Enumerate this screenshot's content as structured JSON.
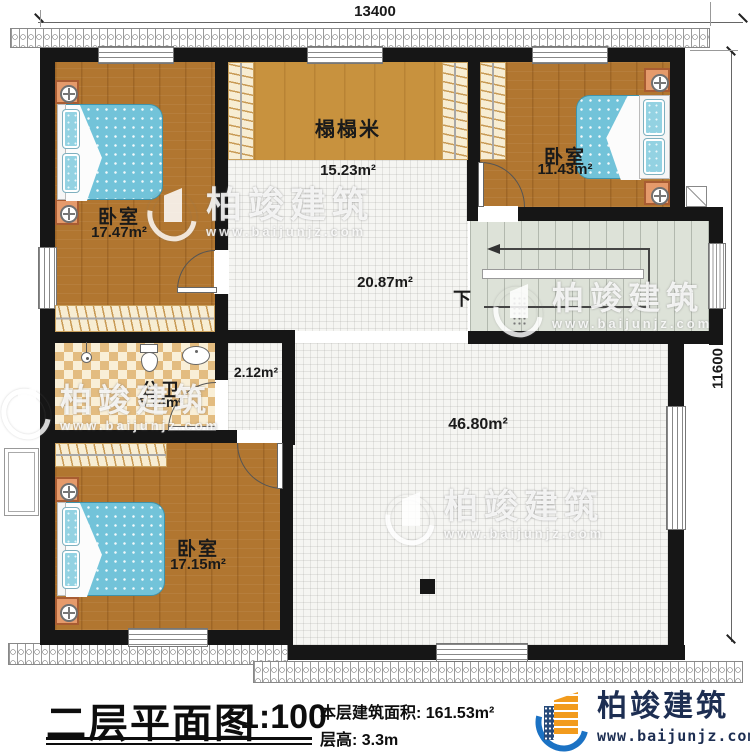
{
  "dimensions": {
    "top": "13400",
    "right": "11600"
  },
  "rooms": {
    "bedroom_top_left": {
      "name": "卧室",
      "area": "17.47m²"
    },
    "tatami": {
      "name": "榻榻米",
      "area": "15.23m²"
    },
    "bedroom_top_right": {
      "name": "卧室",
      "area": "11.43m²"
    },
    "bathroom": {
      "name": "公卫",
      "area": "5.74m²"
    },
    "corridor": {
      "area": "2.12m²"
    },
    "hall_upper": {
      "area": "20.87m²"
    },
    "hall": {
      "area": "46.80m²"
    },
    "bedroom_bottom": {
      "name": "卧室",
      "area": "17.15m²"
    },
    "stairs": {
      "down_label": "下"
    }
  },
  "footer": {
    "title": "二层平面图",
    "scale": "1:100",
    "floor_area": "本层建筑面积: 161.53m²",
    "floor_height": "层高: 3.3m"
  },
  "brand": {
    "name": "柏竣建筑",
    "url": "www.baijunjz.com"
  },
  "watermark": {
    "name": "柏竣建筑",
    "url": "www.baijunjz.com"
  },
  "colors": {
    "accent_blue": "#1b72c4",
    "logo_navy": "#1d2e52",
    "wood": "#b17630",
    "mattress": "#72c3d9"
  }
}
